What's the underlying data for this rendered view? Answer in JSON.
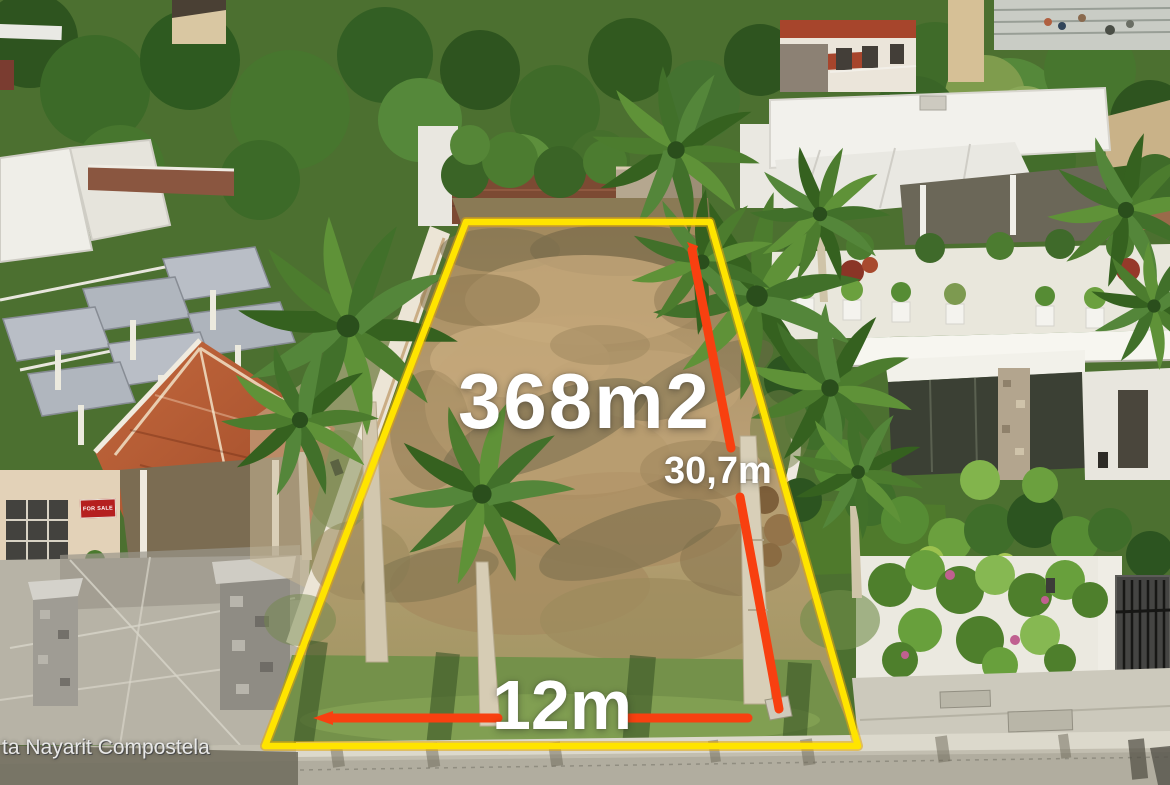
{
  "overlay": {
    "area_label": "368m2",
    "depth_label": "30,7m",
    "width_label": "12m",
    "watermark": "ta Nayarit Compostela",
    "colors": {
      "lot_outline_yellow": "#ffe400",
      "measure_line_red": "#f84010",
      "label_text": "#ffffff"
    }
  },
  "scene": {
    "for_sale_sign": "FOR SALE",
    "palette": {
      "lot_dirt": "#b29367",
      "grass": "#77974a",
      "street": "#c6c2b4",
      "tile_roof": "#b85c35",
      "vegetation": "#41702a"
    }
  }
}
